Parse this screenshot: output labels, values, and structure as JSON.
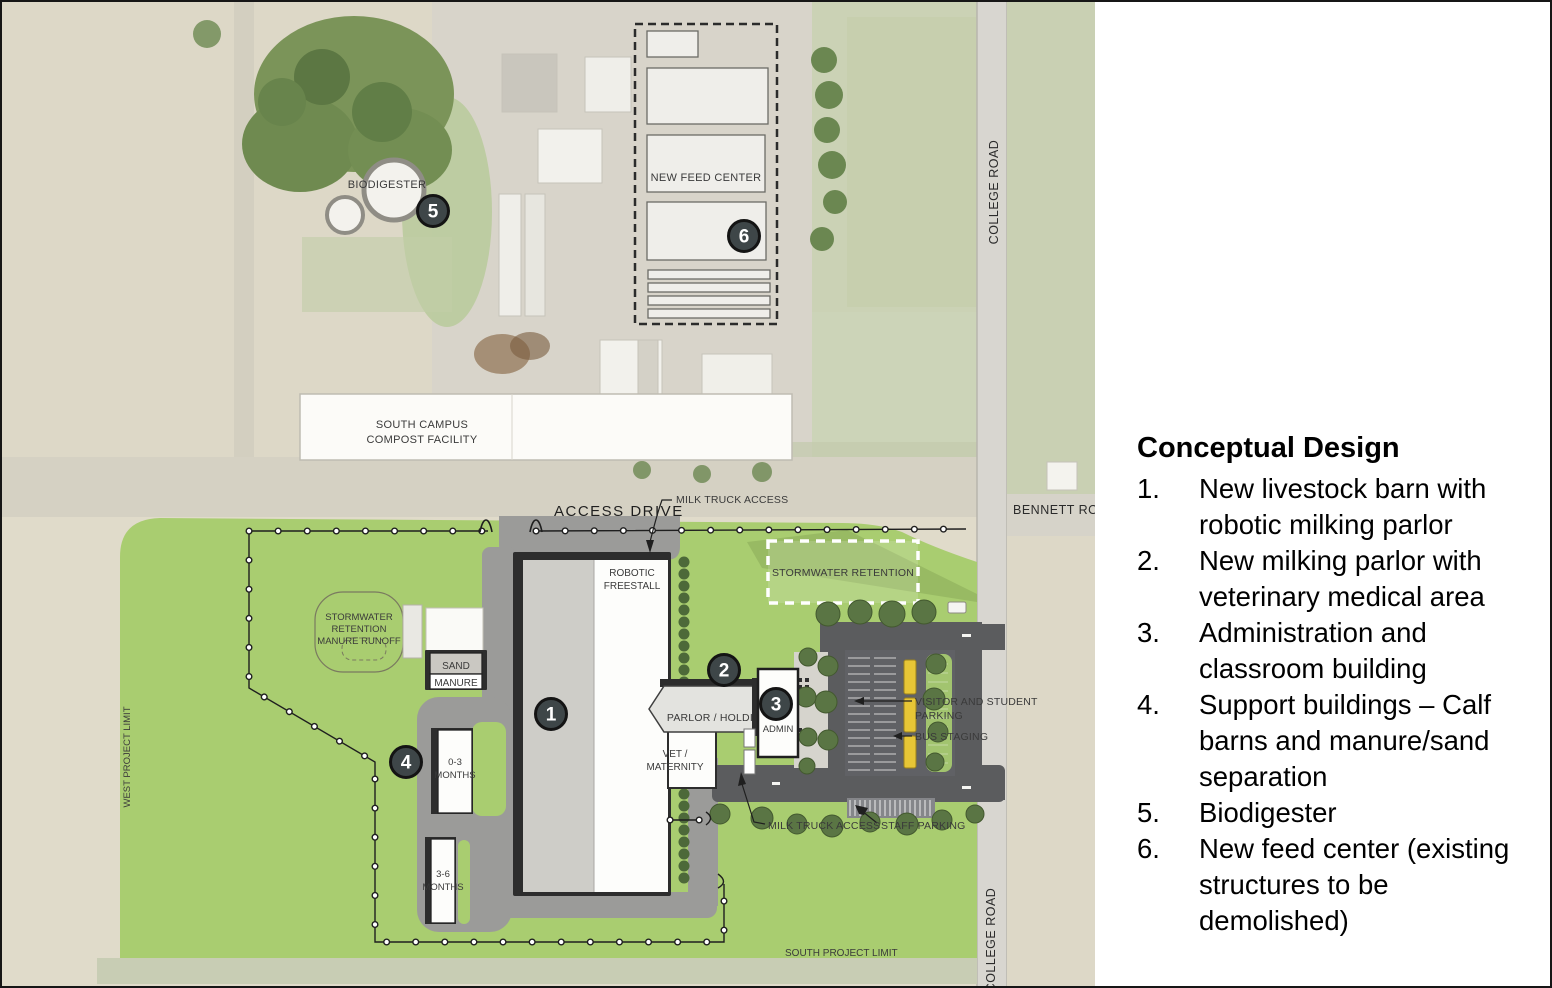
{
  "legend": {
    "title": "Conceptual Design",
    "items": [
      {
        "num": "1.",
        "text": "New livestock barn with robotic milking parlor"
      },
      {
        "num": "2.",
        "text": "New milking parlor with veterinary medical area"
      },
      {
        "num": "3.",
        "text": "Administration and classroom building"
      },
      {
        "num": "4.",
        "text": "Support buildings – Calf barns and manure/sand separation"
      },
      {
        "num": "5.",
        "text": "Biodigester"
      },
      {
        "num": "6.",
        "text": "New feed center (existing structures to be demolished)"
      }
    ]
  },
  "map": {
    "markers": [
      "1",
      "2",
      "3",
      "4",
      "5",
      "6"
    ],
    "labels": {
      "access_drive": "ACCESS DRIVE",
      "milk_truck_access_top": "MILK TRUCK ACCESS",
      "milk_truck_access_bottom": "MILK TRUCK ACCESS",
      "robotic_freestall": [
        "ROBOTIC",
        "FREESTALL"
      ],
      "parlor_holding": "PARLOR / HOLDING",
      "admin": "ADMIN",
      "vet_maternity": [
        "VET /",
        "MATERNITY"
      ],
      "sand_manure": [
        "SAND",
        "MANURE"
      ],
      "calf_0_3": [
        "0-3",
        "MONTHS"
      ],
      "calf_3_6": [
        "3-6",
        "MONTHS"
      ],
      "stormwater_retention": "STORMWATER RETENTION",
      "stormwater_manure_runoff": [
        "STORMWATER",
        "RETENTION",
        "MANURE RUNOFF"
      ],
      "biodigester": "BIODIGESTER",
      "new_feed_center": "NEW FEED CENTER",
      "south_campus_compost": [
        "SOUTH CAMPUS",
        "COMPOST FACILITY"
      ],
      "visitor_student_parking": [
        "VISITOR AND STUDENT",
        "PARKING"
      ],
      "bus_staging": "BUS STAGING",
      "staff_parking": "STAFF PARKING",
      "college_road": "COLLEGE ROAD",
      "bennett_road": "BENNETT ROAD",
      "west_project_limit": "WEST PROJECT LIMIT",
      "south_project_limit": "SOUTH PROJECT LIMIT"
    },
    "colors": {
      "site_green": "#a9cd70",
      "road_dark": "#5b5c5e",
      "road_medium": "#9b9b99",
      "marker_fill": "#3e4648",
      "bus_yellow": "#e7c636",
      "boundary": "#1f1f1f",
      "building_white": "#fdfdfb",
      "barn_gray": "#cecdc8"
    }
  }
}
